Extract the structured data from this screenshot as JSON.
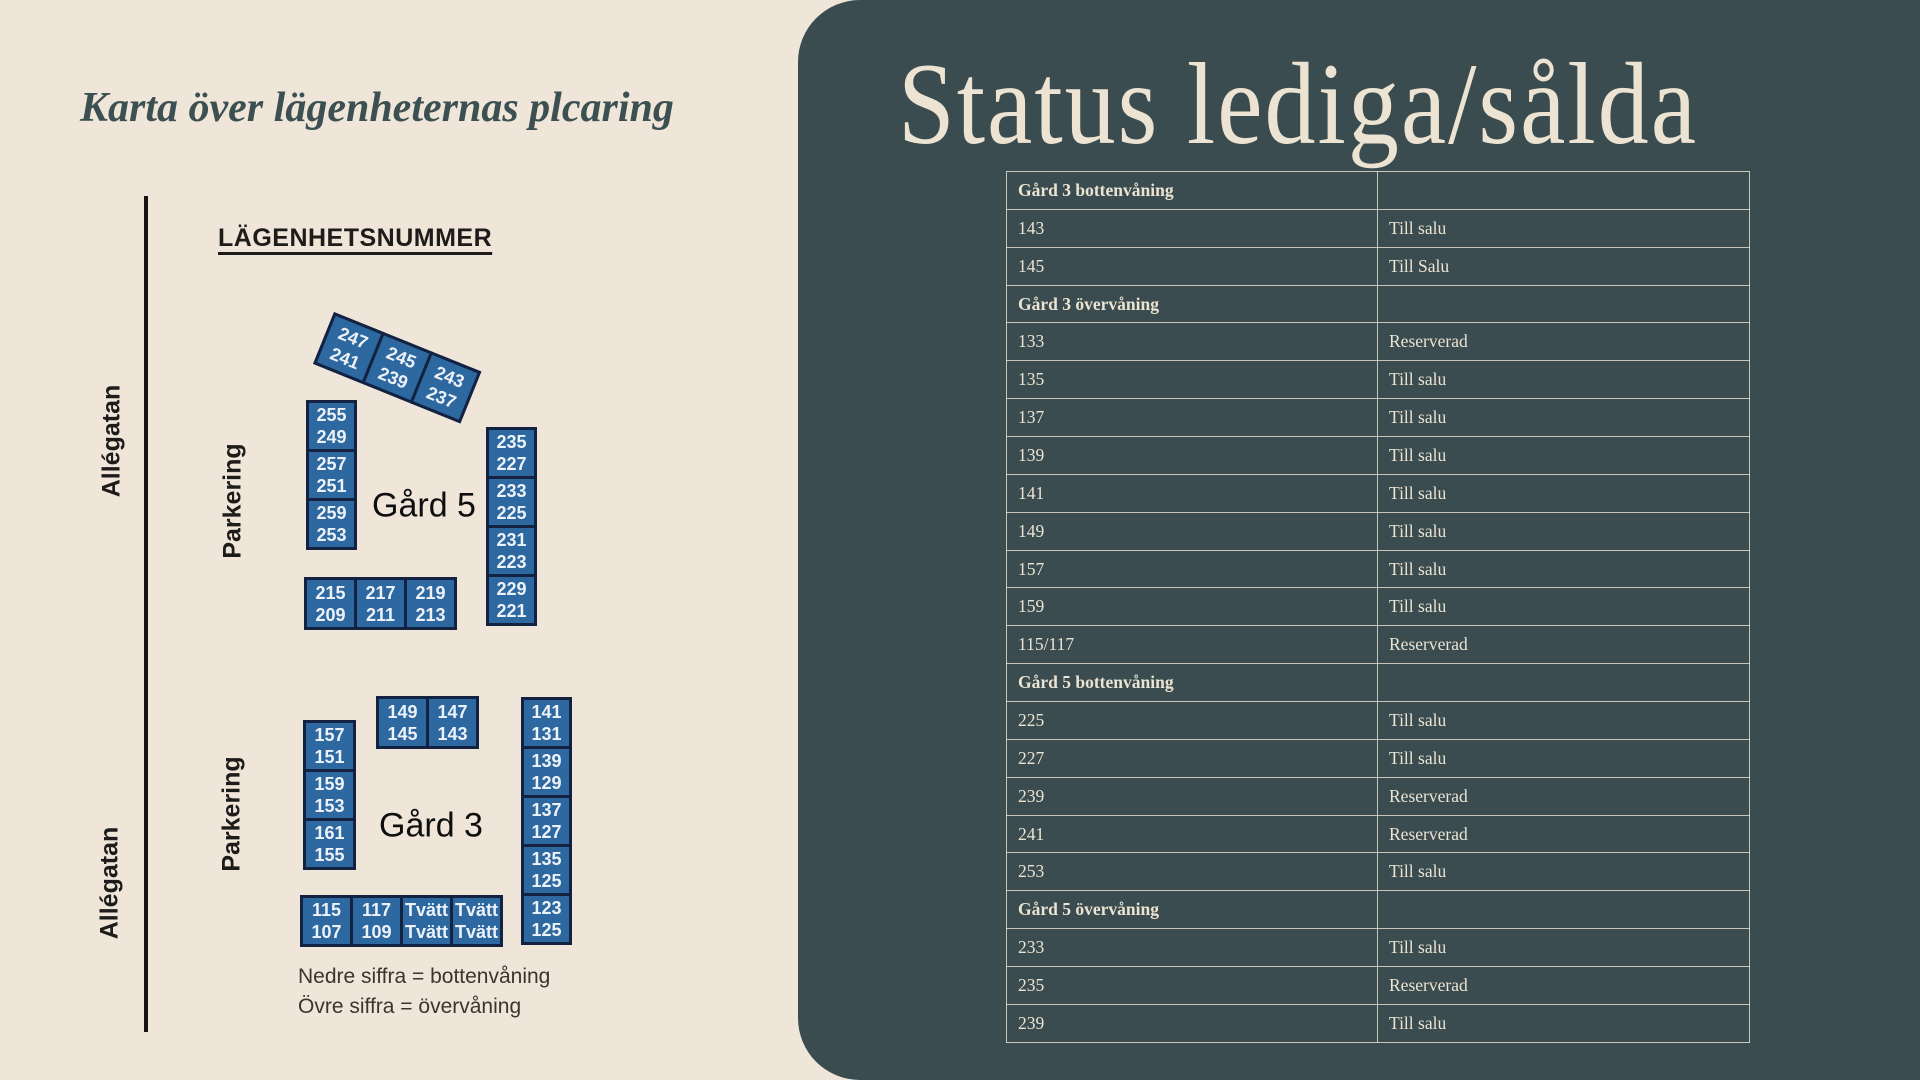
{
  "left": {
    "title": "Karta över lägenheternas plcaring",
    "map_header": "LÄGENHETSNUMMER",
    "streets": {
      "top": "Allégatan",
      "bottom": "Allégatan"
    },
    "parking": {
      "top": "Parkering",
      "bottom": "Parkering"
    },
    "legend": [
      "Nedre siffra = bottenvåning",
      "Övre siffra = övervåning"
    ],
    "gard5": {
      "label": "Gård 5",
      "tilted_row": [
        {
          "top": "247",
          "bottom": "241"
        },
        {
          "top": "245",
          "bottom": "239"
        },
        {
          "top": "243",
          "bottom": "237"
        }
      ],
      "left_col": [
        {
          "top": "255",
          "bottom": "249"
        },
        {
          "top": "257",
          "bottom": "251"
        },
        {
          "top": "259",
          "bottom": "253"
        }
      ],
      "right_col": [
        {
          "top": "235",
          "bottom": "227"
        },
        {
          "top": "233",
          "bottom": "225"
        },
        {
          "top": "231",
          "bottom": "223"
        },
        {
          "top": "229",
          "bottom": "221"
        }
      ],
      "bottom_row": [
        {
          "top": "215",
          "bottom": "209"
        },
        {
          "top": "217",
          "bottom": "211"
        },
        {
          "top": "219",
          "bottom": "213"
        }
      ]
    },
    "gard3": {
      "label": "Gård 3",
      "top_row": [
        {
          "top": "149",
          "bottom": "145"
        },
        {
          "top": "147",
          "bottom": "143"
        }
      ],
      "left_col": [
        {
          "top": "157",
          "bottom": "151"
        },
        {
          "top": "159",
          "bottom": "153"
        },
        {
          "top": "161",
          "bottom": "155"
        }
      ],
      "right_col": [
        {
          "top": "141",
          "bottom": "131"
        },
        {
          "top": "139",
          "bottom": "129"
        },
        {
          "top": "137",
          "bottom": "127"
        },
        {
          "top": "135",
          "bottom": "125"
        },
        {
          "top": "123",
          "bottom": "125"
        }
      ],
      "bottom_row": [
        {
          "top": "115",
          "bottom": "107"
        },
        {
          "top": "117",
          "bottom": "109"
        },
        {
          "top": "Tvätt",
          "bottom": "Tvätt"
        },
        {
          "top": "Tvätt",
          "bottom": "Tvätt"
        }
      ]
    }
  },
  "right": {
    "title": "Status lediga/sålda",
    "table": {
      "rows": [
        {
          "label": "Gård 3 bottenvåning",
          "status": "",
          "header": true
        },
        {
          "label": "143",
          "status": "Till salu",
          "header": false
        },
        {
          "label": "145",
          "status": "Till Salu",
          "header": false
        },
        {
          "label": "Gård 3 övervåning",
          "status": "",
          "header": true
        },
        {
          "label": "133",
          "status": "Reserverad",
          "header": false
        },
        {
          "label": "135",
          "status": "Till salu",
          "header": false
        },
        {
          "label": "137",
          "status": "Till salu",
          "header": false
        },
        {
          "label": "139",
          "status": "Till salu",
          "header": false
        },
        {
          "label": "141",
          "status": "Till salu",
          "header": false
        },
        {
          "label": "149",
          "status": "Till salu",
          "header": false
        },
        {
          "label": "157",
          "status": "Till salu",
          "header": false
        },
        {
          "label": "159",
          "status": "Till salu",
          "header": false
        },
        {
          "label": "115/117",
          "status": "Reserverad",
          "header": false
        },
        {
          "label": "Gård 5 bottenvåning",
          "status": "",
          "header": true
        },
        {
          "label": "225",
          "status": "Till salu",
          "header": false
        },
        {
          "label": "227",
          "status": "Till salu",
          "header": false
        },
        {
          "label": "239",
          "status": "Reserverad",
          "header": false
        },
        {
          "label": "241",
          "status": "Reserverad",
          "header": false
        },
        {
          "label": "253",
          "status": "Till salu",
          "header": false
        },
        {
          "label": "Gård 5 övervåning",
          "status": "",
          "header": true
        },
        {
          "label": "233",
          "status": "Till salu",
          "header": false
        },
        {
          "label": "235",
          "status": "Reserverad",
          "header": false
        },
        {
          "label": "239",
          "status": "Till salu",
          "header": false
        }
      ]
    }
  },
  "colors": {
    "background_cream": "#efe5d9",
    "panel_dark": "#3a4c4f",
    "box_blue": "#2d68a0",
    "box_border": "#122240",
    "table_text": "#ece4d3",
    "map_title": "#3c5052"
  }
}
